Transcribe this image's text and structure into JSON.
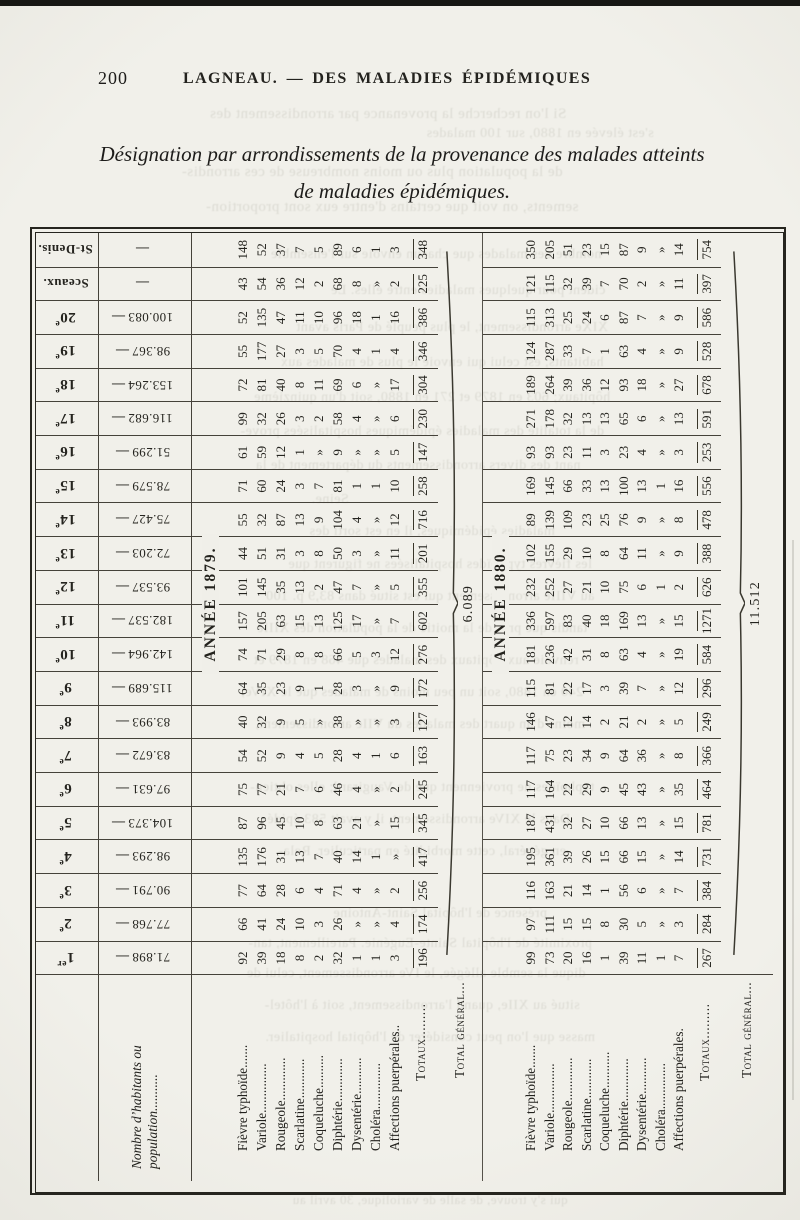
{
  "page": {
    "number": "200",
    "running_title": "LAGNEAU. — DES MALADIES ÉPIDÉMIQUES",
    "title_line1": "Désignation par arrondissements de la provenance des malades atteints",
    "title_line2": "de maladies épidémiques."
  },
  "table": {
    "col_headers": [
      {
        "n": "1",
        "s": "er"
      },
      {
        "n": "2",
        "s": "e"
      },
      {
        "n": "3",
        "s": "e"
      },
      {
        "n": "4",
        "s": "e"
      },
      {
        "n": "5",
        "s": "e"
      },
      {
        "n": "6",
        "s": "e"
      },
      {
        "n": "7",
        "s": "e"
      },
      {
        "n": "8",
        "s": "e"
      },
      {
        "n": "9",
        "s": "e"
      },
      {
        "n": "10",
        "s": "e"
      },
      {
        "n": "11",
        "s": "e"
      },
      {
        "n": "12",
        "s": "e"
      },
      {
        "n": "13",
        "s": "e"
      },
      {
        "n": "14",
        "s": "e"
      },
      {
        "n": "15",
        "s": "e"
      },
      {
        "n": "16",
        "s": "e"
      },
      {
        "n": "17",
        "s": "e"
      },
      {
        "n": "18",
        "s": "e"
      },
      {
        "n": "19",
        "s": "e"
      },
      {
        "n": "20",
        "s": "e"
      },
      {
        "n": "Sceaux.",
        "s": ""
      },
      {
        "n": "St-Denis.",
        "s": ""
      }
    ],
    "population_label_1": "Nombre d’habitants ou",
    "population_label_2": "population...........",
    "population": [
      "71.898",
      "77.768",
      "90.791",
      "98.293",
      "104.373",
      "97.631",
      "83.672",
      "83.993",
      "115.689",
      "142.964",
      "182.537",
      "93.537",
      "72.203",
      "75.427",
      "78.579",
      "51.299",
      "116.682",
      "153.264",
      "98.367",
      "100.083",
      "",
      ""
    ],
    "sections": [
      {
        "year_label": "ANNÉE 1879.",
        "rows": [
          {
            "label": "Fièvre typhoïde.......",
            "values": [
              "92",
              "66",
              "77",
              "135",
              "87",
              "75",
              "54",
              "40",
              "64",
              "74",
              "157",
              "101",
              "44",
              "55",
              "71",
              "61",
              "99",
              "72",
              "55",
              "52",
              "43",
              "148"
            ]
          },
          {
            "label": "Variole...............",
            "values": [
              "39",
              "41",
              "64",
              "176",
              "96",
              "77",
              "52",
              "32",
              "35",
              "71",
              "205",
              "145",
              "51",
              "32",
              "60",
              "59",
              "32",
              "81",
              "177",
              "135",
              "54",
              "52"
            ]
          },
          {
            "label": "Rougeole.............",
            "values": [
              "18",
              "24",
              "28",
              "31",
              "45",
              "21",
              "9",
              "9",
              "23",
              "29",
              "63",
              "35",
              "31",
              "87",
              "24",
              "12",
              "26",
              "40",
              "27",
              "47",
              "36",
              "37"
            ]
          },
          {
            "label": "Scarlatine............",
            "values": [
              "8",
              "10",
              "6",
              "13",
              "10",
              "7",
              "4",
              "5",
              "9",
              "8",
              "15",
              "13",
              "3",
              "13",
              "3",
              "1",
              "3",
              "8",
              "3",
              "11",
              "12",
              "7"
            ]
          },
          {
            "label": "Coqueluche..........",
            "values": [
              "2",
              "3",
              "4",
              "7",
              "8",
              "6",
              "5",
              "»",
              "1",
              "8",
              "13",
              "2",
              "8",
              "9",
              "7",
              "»",
              "2",
              "11",
              "5",
              "10",
              "2",
              "5"
            ]
          },
          {
            "label": "Diphtérie.............",
            "values": [
              "32",
              "26",
              "71",
              "40",
              "63",
              "46",
              "28",
              "38",
              "28",
              "66",
              "125",
              "47",
              "50",
              "104",
              "81",
              "9",
              "58",
              "69",
              "70",
              "96",
              "68",
              "89"
            ]
          },
          {
            "label": "Dysentérie...........",
            "values": [
              "1",
              "»",
              "4",
              "14",
              "21",
              "4",
              "4",
              "»",
              "3",
              "5",
              "17",
              "7",
              "3",
              "4",
              "1",
              "»",
              "4",
              "6",
              "4",
              "18",
              "8",
              "6"
            ]
          },
          {
            "label": "Choléra..............",
            "values": [
              "1",
              "»",
              "»",
              "1",
              "»",
              "»",
              "1",
              "»",
              "»",
              "3",
              "»",
              "»",
              "»",
              "»",
              "1",
              "»",
              "»",
              "»",
              "1",
              "1",
              "»",
              "1"
            ]
          },
          {
            "label": "Affections puerpérales..",
            "values": [
              "3",
              "4",
              "2",
              "»",
              "15",
              "2",
              "6",
              "3",
              "9",
              "12",
              "7",
              "5",
              "11",
              "12",
              "10",
              "5",
              "6",
              "17",
              "4",
              "16",
              "2",
              "3"
            ]
          }
        ],
        "totaux_label": "Totaux.........",
        "totaux": [
          "196",
          "174",
          "256",
          "417",
          "345",
          "245",
          "163",
          "127",
          "172",
          "276",
          "602",
          "355",
          "201",
          "716",
          "258",
          "147",
          "230",
          "304",
          "346",
          "386",
          "225",
          "348"
        ],
        "total_general_label": "Total général...",
        "total_general": "6.089"
      },
      {
        "year_label": "ANNÉE 1880.",
        "rows": [
          {
            "label": "Fièvre typhoïde.......",
            "values": [
              "99",
              "97",
              "116",
              "195",
              "187",
              "117",
              "117",
              "146",
              "115",
              "181",
              "336",
              "232",
              "102",
              "89",
              "169",
              "93",
              "271",
              "189",
              "124",
              "115",
              "121",
              "350"
            ]
          },
          {
            "label": "Variole...............",
            "values": [
              "73",
              "111",
              "163",
              "361",
              "431",
              "164",
              "75",
              "47",
              "81",
              "236",
              "597",
              "252",
              "155",
              "139",
              "145",
              "93",
              "178",
              "264",
              "287",
              "313",
              "115",
              "205"
            ]
          },
          {
            "label": "Rougeole.............",
            "values": [
              "20",
              "15",
              "21",
              "39",
              "32",
              "22",
              "23",
              "12",
              "22",
              "42",
              "83",
              "27",
              "29",
              "109",
              "66",
              "23",
              "32",
              "39",
              "33",
              "25",
              "32",
              "51"
            ]
          },
          {
            "label": "Scarlatine............",
            "values": [
              "16",
              "15",
              "14",
              "26",
              "27",
              "29",
              "34",
              "14",
              "17",
              "31",
              "40",
              "21",
              "10",
              "23",
              "33",
              "11",
              "13",
              "36",
              "7",
              "24",
              "39",
              "23"
            ]
          },
          {
            "label": "Coqueluche...........",
            "values": [
              "1",
              "8",
              "1",
              "15",
              "10",
              "9",
              "9",
              "2",
              "3",
              "8",
              "18",
              "10",
              "8",
              "25",
              "13",
              "3",
              "13",
              "12",
              "1",
              "6",
              "7",
              "15"
            ]
          },
          {
            "label": "Diphtérie.............",
            "values": [
              "39",
              "30",
              "56",
              "66",
              "66",
              "45",
              "64",
              "21",
              "39",
              "63",
              "169",
              "75",
              "64",
              "76",
              "100",
              "23",
              "65",
              "93",
              "63",
              "87",
              "70",
              "87"
            ]
          },
          {
            "label": "Dysentérie...........",
            "values": [
              "11",
              "5",
              "6",
              "15",
              "13",
              "43",
              "36",
              "2",
              "7",
              "4",
              "13",
              "6",
              "11",
              "9",
              "13",
              "4",
              "6",
              "18",
              "4",
              "7",
              "2",
              "9"
            ]
          },
          {
            "label": "Choléra..............",
            "values": [
              "1",
              "»",
              "»",
              "»",
              "»",
              "»",
              "»",
              "»",
              "»",
              "»",
              "»",
              "1",
              "»",
              "»",
              "1",
              "»",
              "»",
              "»",
              "»",
              "»",
              "»",
              "»"
            ]
          },
          {
            "label": "Affections puerpérales.",
            "values": [
              "7",
              "3",
              "7",
              "14",
              "15",
              "35",
              "8",
              "5",
              "12",
              "19",
              "15",
              "2",
              "9",
              "8",
              "16",
              "3",
              "13",
              "27",
              "9",
              "9",
              "11",
              "14"
            ]
          }
        ],
        "totaux_label": "Totaux.........",
        "totaux": [
          "267",
          "284",
          "384",
          "731",
          "781",
          "464",
          "366",
          "249",
          "296",
          "584",
          "1271",
          "626",
          "388",
          "478",
          "556",
          "253",
          "591",
          "678",
          "528",
          "586",
          "397",
          "754"
        ],
        "total_general_label": "Total général...",
        "total_general": "11.512"
      }
    ]
  },
  "bleedthrough": [
    {
      "t": "Si l'on recherche la provenance par arrondissement des",
      "x": 388,
      "y": 106,
      "s": 15
    },
    {
      "t": "s'est élevée en 1880, sur 100 malades",
      "x": 540,
      "y": 126,
      "s": 14
    },
    {
      "t": "de la population plus ou moins nombreuse de ces arrondis-",
      "x": 372,
      "y": 164,
      "s": 15
    },
    {
      "t": "sements, on voit que certains d'entre eux sont proportion-",
      "x": 392,
      "y": 199,
      "s": 15
    },
    {
      "t": "nombre des malades que chacun envoie sur l'ensemble",
      "x": 436,
      "y": 247,
      "s": 14
    },
    {
      "t": "cident pour quelques maladies entre elles. Le",
      "x": 468,
      "y": 283,
      "s": 14
    },
    {
      "t": "XIXe arrondissement, le plus peuplé de Paris avant",
      "x": 452,
      "y": 320,
      "s": 14
    },
    {
      "t": "habitants, est celui qui envoie le plus de malades aux",
      "x": 442,
      "y": 355,
      "s": 14
    },
    {
      "t": "hôpitaux; 603 en 1879 et 271 en 1880, soit d'un quinzième",
      "x": 432,
      "y": 390,
      "s": 14
    },
    {
      "t": "de la totalité des maladies épidémiques hospitalisées prove-",
      "x": 422,
      "y": 424,
      "s": 14
    },
    {
      "t": "nant des divers arrondissements du département de la",
      "x": 418,
      "y": 458,
      "s": 14
    },
    {
      "t": "Seine.",
      "x": 330,
      "y": 492,
      "s": 14
    },
    {
      "t": "maladies épidémiques, il en est sorti des",
      "x": 432,
      "y": 524,
      "s": 14
    },
    {
      "t": "les fièvres typhoïdes hospitalisées ne figurent que",
      "x": 440,
      "y": 557,
      "s": 14
    },
    {
      "t": "au VIIIe arrondissement qui est situé dans 83,9 p. 100",
      "x": 430,
      "y": 589,
      "s": 14
    },
    {
      "t": "tandis que près de la moitié de la population des XIIIe",
      "x": 422,
      "y": 621,
      "s": 14
    },
    {
      "t": "renvoie aux hôpitaux des malades que 468 en 1879 et",
      "x": 416,
      "y": 653,
      "s": 14
    },
    {
      "t": "240 en 1880, soit un peu moins de malades que le XIVe,",
      "x": 412,
      "y": 685,
      "s": 14
    },
    {
      "t": "moins d'un quart des malades du VIIe arrondissement,",
      "x": 420,
      "y": 717,
      "s": 14
    },
    {
      "t": "typhoïdes ne proviennent que de Vaugirard; elles obtien-",
      "x": 422,
      "y": 780,
      "s": 14
    },
    {
      "t": "Dans le XIVe arrondissement, il y avait 583 épidé-",
      "x": 416,
      "y": 812,
      "s": 14
    },
    {
      "t": "en général, cette morbidité en particulier. Rela-",
      "x": 422,
      "y": 844,
      "s": 14
    },
    {
      "t": "présence de l'hôpital Saint-Antoine",
      "x": 440,
      "y": 906,
      "s": 14
    },
    {
      "t": "proximité de l'hôpital Sainte-Eugénie. Pareillement, tan-",
      "x": 420,
      "y": 936,
      "s": 14
    },
    {
      "t": "dique la semble allégée, le IVe arrondissement, celui de",
      "x": 416,
      "y": 966,
      "s": 14
    },
    {
      "t": "situé au XIIe, quand l'arrondissement, soit à l'hôtel-",
      "x": 422,
      "y": 998,
      "s": 14
    },
    {
      "t": "masse que l'on peut considérer de l'hôpital hospitalier.",
      "x": 430,
      "y": 1030,
      "s": 14
    },
    {
      "t": "qui s'y trouve, de salle de variolique, 30 avril au",
      "x": 430,
      "y": 1192,
      "s": 13
    }
  ]
}
